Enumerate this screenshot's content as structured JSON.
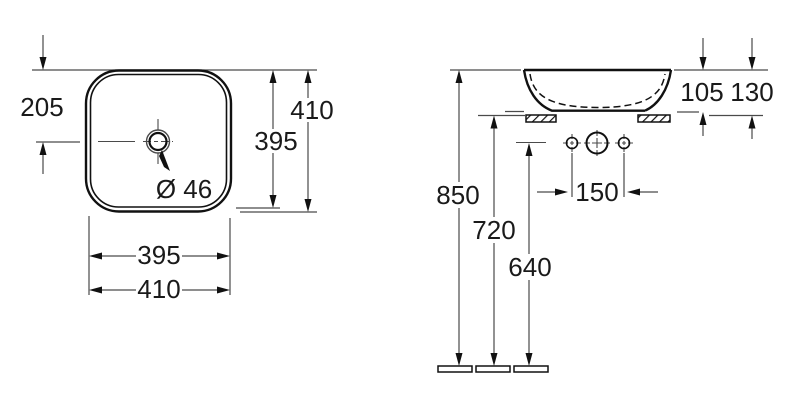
{
  "views": {
    "top": {
      "dims": {
        "center_offset": "205",
        "outer_height": "410",
        "inner_height": "395",
        "drain_diameter": "Ø 46",
        "inner_width": "395",
        "outer_width": "410"
      }
    },
    "side": {
      "dims": {
        "basin_height": "105",
        "total_height": "130",
        "rim_to_floor": "850",
        "counter_to_floor": "720",
        "tap_line_to_floor": "640",
        "tap_hole_spacing": "150"
      }
    }
  },
  "colors": {
    "background": "#ffffff",
    "outline": "#111111",
    "dimension_line": "#4a4a4a",
    "text": "#1a1a1a"
  }
}
